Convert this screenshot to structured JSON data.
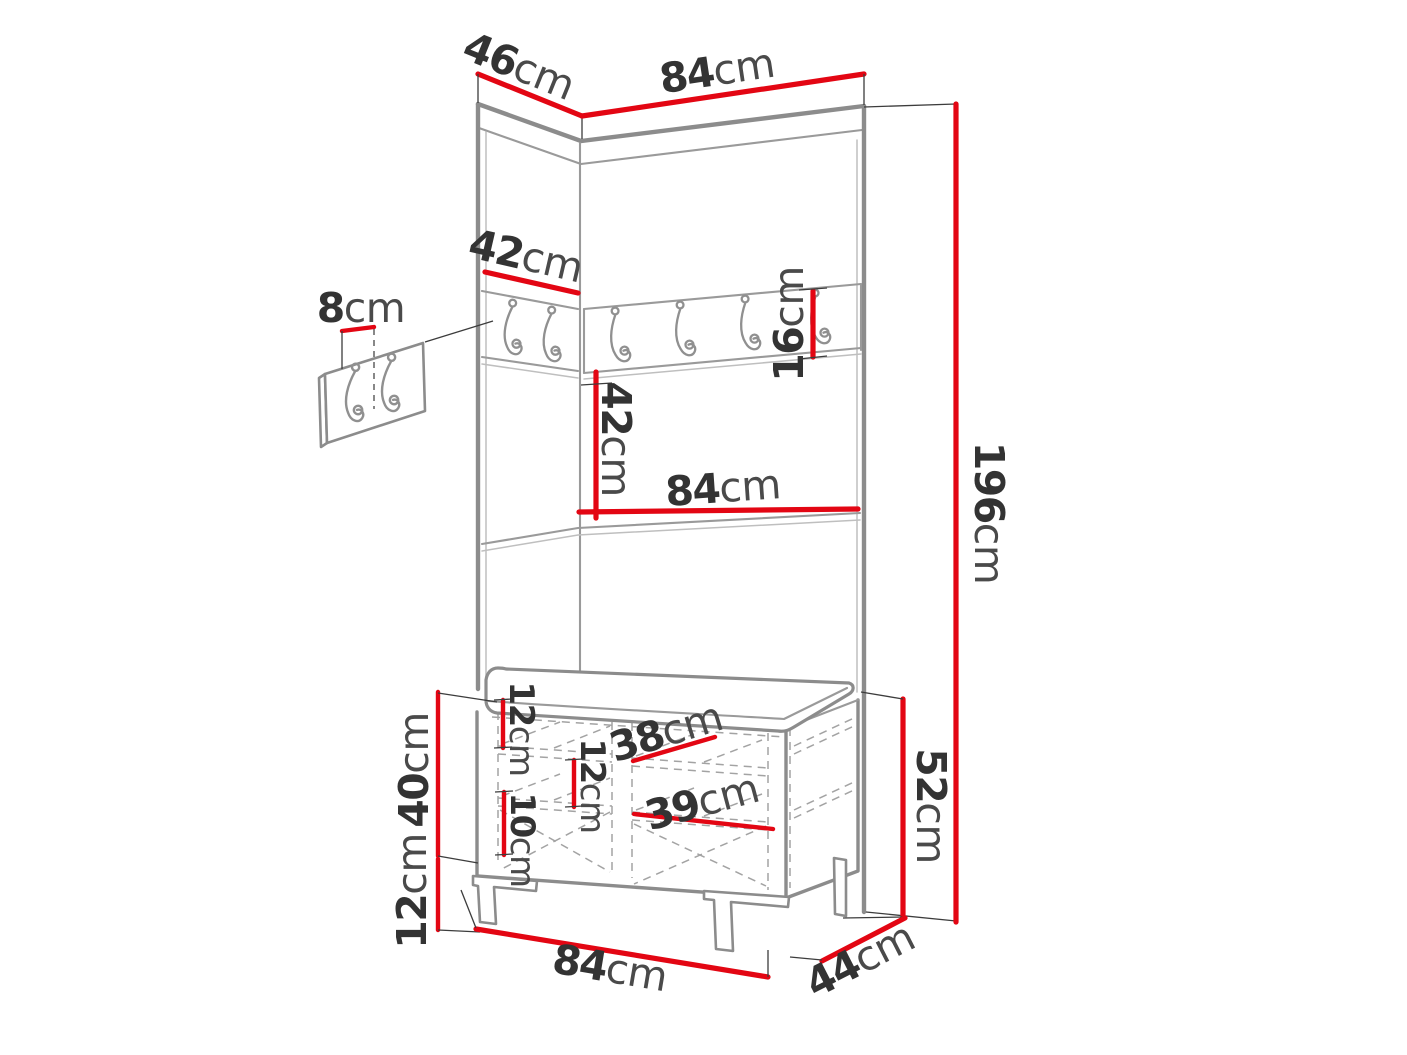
{
  "figure": {
    "type": "furniture-dimension-diagram",
    "subject": "hallway wardrobe set: corner wall panels with coat-hook rail, shelf and shoe bench with cushion",
    "hook_rail_hook_count": 6,
    "detail_panel_hook_count": 2
  },
  "palette": {
    "dimension_red": "#e30613",
    "outline_gray": "#8c8c8c",
    "dashed_gray": "#a3a3a3",
    "text_dark": "#333333",
    "background": "#ffffff"
  },
  "dimensions": {
    "top_depth": {
      "value": "46",
      "unit": "cm"
    },
    "top_width": {
      "value": "84",
      "unit": "cm"
    },
    "rail_left_width": {
      "value": "42",
      "unit": "cm"
    },
    "hook_offset": {
      "value": "8",
      "unit": "cm"
    },
    "rail_height": {
      "value": "16",
      "unit": "cm"
    },
    "panel_mid_height": {
      "value": "42",
      "unit": "cm"
    },
    "shelf_width": {
      "value": "84",
      "unit": "cm"
    },
    "total_height": {
      "value": "196",
      "unit": "cm"
    },
    "bench_body_height": {
      "value": "40",
      "unit": "cm"
    },
    "bench_leg_height": {
      "value": "12",
      "unit": "cm"
    },
    "door_inner_top": {
      "value": "12",
      "unit": "cm"
    },
    "inner_gap": {
      "value": "10",
      "unit": "cm"
    },
    "inner_mid": {
      "value": "12",
      "unit": "cm"
    },
    "left_door_width": {
      "value": "38",
      "unit": "cm"
    },
    "right_door_width": {
      "value": "39",
      "unit": "cm"
    },
    "bench_height": {
      "value": "52",
      "unit": "cm"
    },
    "bench_width": {
      "value": "84",
      "unit": "cm"
    },
    "bench_depth": {
      "value": "44",
      "unit": "cm"
    }
  }
}
